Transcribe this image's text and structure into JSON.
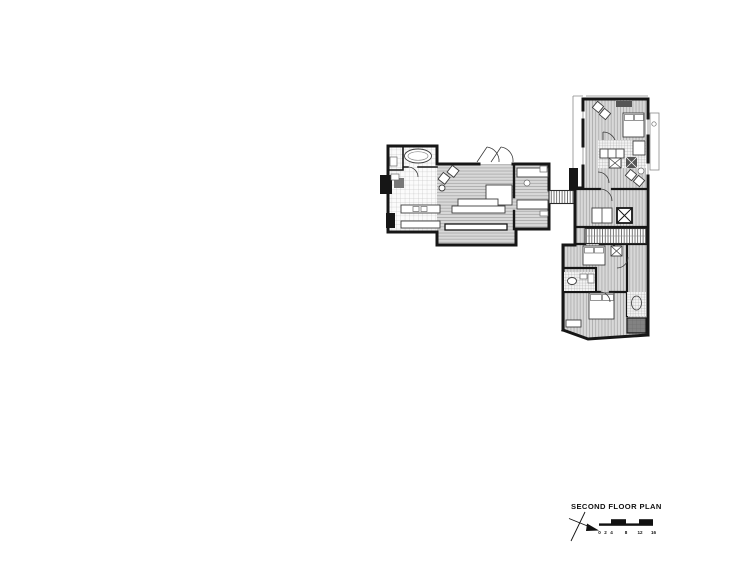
{
  "page": {
    "background_color": "#ffffff"
  },
  "drawing": {
    "type": "architectural-floor-plan",
    "title": "SECOND FLOOR PLAN",
    "scale_bar": {
      "unit_labels": [
        "0",
        "2",
        "4",
        "8",
        "12",
        "16"
      ]
    },
    "colors": {
      "walls": "#161616",
      "floor_fill": "#d8d8d8",
      "floor_stripe": "#a3a3a3",
      "tile_line": "#b8b8b8",
      "dark_fixture": "#5a5a5a",
      "background": "#ffffff"
    },
    "features": [
      "north-arrow-icon",
      "scale-bar",
      "bathtub-icon",
      "bed-icon",
      "stairs",
      "bridge-walkway",
      "elevator-shaft",
      "kitchen-counter",
      "sofa",
      "lounge-chairs"
    ]
  }
}
